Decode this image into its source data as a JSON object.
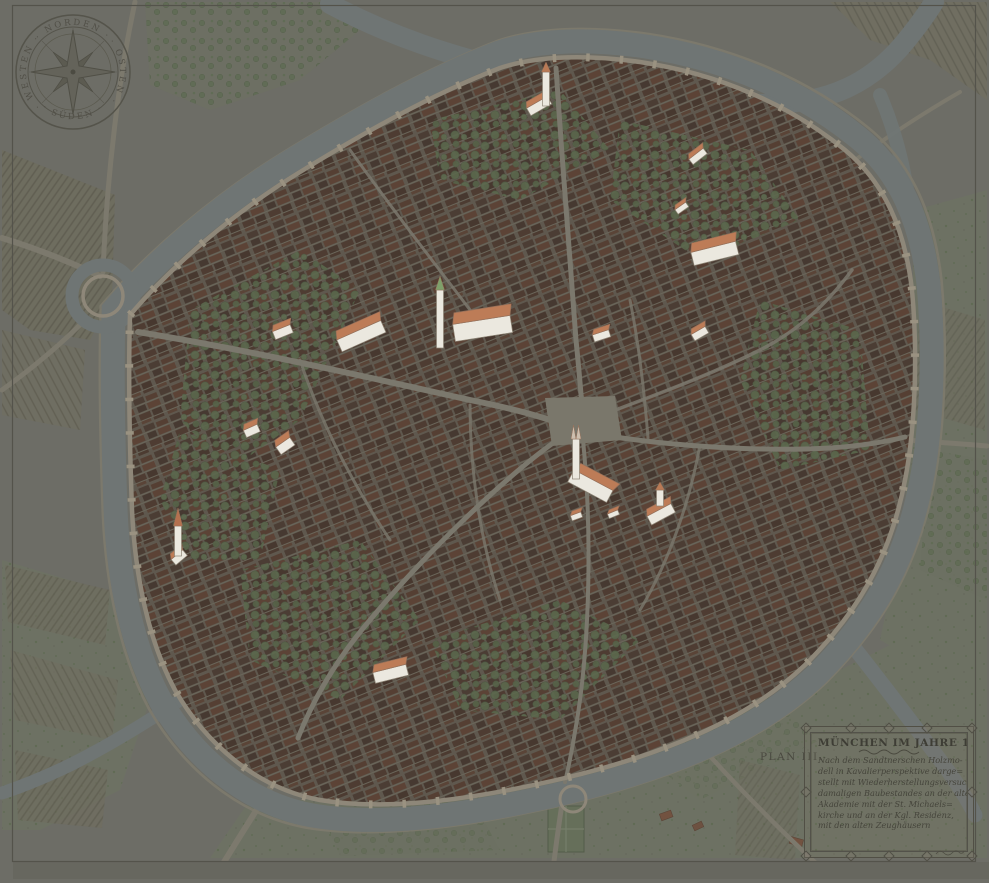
{
  "plan_label": "PLAN III.",
  "compass": {
    "north": "· NORDEN ·",
    "east": "· OSTEN ·",
    "south": "· SÜDEN ·",
    "west": "· WESTEN ·"
  },
  "cartouche": {
    "title": "MÜNCHEN IM JAHRE 1570·",
    "lines": [
      "Nach dem Sandtnerschen Holzmo-",
      "dell in Kavalierperspektive darge=",
      "stellt mit Wiederherstellungsversuch des",
      "damaligen Baubestandes an der alten",
      "Akademie mit der St. Michaels=",
      "kirche und an der Kgl. Residenz,",
      "mit den alten Zeughäusern"
    ]
  },
  "map": {
    "colors": {
      "background": "#6d6d66",
      "water": "#6f7574",
      "wall": "#8e8779",
      "wall_towers": "#9a9281",
      "roofs_dark": "#4b3d34",
      "trees": "#5b684d",
      "highlight_wall": "#ebe8df",
      "highlight_roof": "#bd7c57",
      "highlight_roof_edge": "#96705a",
      "highlight_outline": "#8e8576",
      "highlight_spire_green": "#7fa06a"
    },
    "highlights": [
      {
        "x": 538,
        "y": 104,
        "w": 24,
        "h": 14,
        "rot": -30,
        "tower": {
          "dx": 8,
          "dy": -32,
          "h": 34,
          "s": 10,
          "spire": "#b97a55"
        }
      },
      {
        "x": 697,
        "y": 155,
        "w": 18,
        "h": 11,
        "rot": -38
      },
      {
        "x": 681,
        "y": 207,
        "w": 13,
        "h": 9,
        "rot": -35
      },
      {
        "x": 714,
        "y": 250,
        "w": 46,
        "h": 22,
        "rot": -14
      },
      {
        "x": 282,
        "y": 330,
        "w": 19,
        "h": 14,
        "rot": -22
      },
      {
        "x": 360,
        "y": 333,
        "w": 48,
        "h": 21,
        "rot": -24
      },
      {
        "x": 482,
        "y": 324,
        "w": 58,
        "h": 28,
        "rot": -9,
        "tower": {
          "dx": -42,
          "dy": -34,
          "h": 58,
          "s": 14,
          "spire": "#7fa06a"
        }
      },
      {
        "x": 601,
        "y": 334,
        "w": 17,
        "h": 12,
        "rot": -18
      },
      {
        "x": 699,
        "y": 332,
        "w": 16,
        "h": 12,
        "rot": -30
      },
      {
        "x": 251,
        "y": 429,
        "w": 15,
        "h": 13,
        "rot": -24
      },
      {
        "x": 284,
        "y": 444,
        "w": 17,
        "h": 15,
        "rot": -35
      },
      {
        "x": 592,
        "y": 483,
        "w": 44,
        "h": 22,
        "rot": 28,
        "tower": {
          "dx": -16,
          "dy": -44,
          "h": 40,
          "s": 14,
          "twin": true,
          "spire": "#cdbfae"
        }
      },
      {
        "x": 576,
        "y": 515,
        "w": 11,
        "h": 9,
        "rot": -20
      },
      {
        "x": 613,
        "y": 513,
        "w": 11,
        "h": 8,
        "rot": -22
      },
      {
        "x": 660,
        "y": 512,
        "w": 27,
        "h": 16,
        "rot": -28,
        "tower": {
          "dx": 0,
          "dy": -22,
          "h": 16,
          "s": 8,
          "spire": "#b97a55"
        }
      },
      {
        "x": 178,
        "y": 556,
        "w": 15,
        "h": 12,
        "rot": -40,
        "tower": {
          "dx": 0,
          "dy": -30,
          "h": 30,
          "s": 18,
          "spire": "#b4714f"
        }
      },
      {
        "x": 390,
        "y": 671,
        "w": 34,
        "h": 18,
        "rot": -14
      }
    ]
  }
}
